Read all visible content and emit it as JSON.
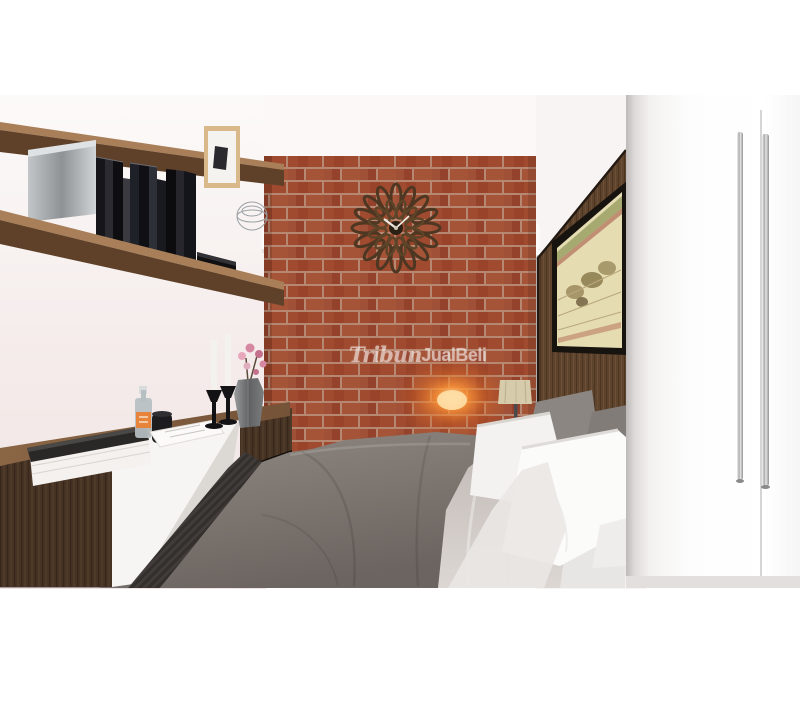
{
  "meta": {
    "type": "interior-3d-render",
    "description": "3D architectural render of a modern bedroom: central exposed red-brick accent wall with sunburst wall clock, flanked by recessed windows with white fluted column curtains, dark walnut floating shelves with books on the left above a floating media console with candlesticks and a vase of pink flowers, a double bed with gray duvet and white pillows in front of a dark wood headboard panel bearing a framed antique map, and a white two-door wardrobe with long steel handles in the right foreground."
  },
  "watermark": {
    "part1": "Tribun",
    "part2": "JualBeli",
    "color": "#ffffff"
  },
  "palette": {
    "wall_left": "#f2e9e8",
    "brick": "#a84f33",
    "mortar": "#c0927a",
    "wood_dark": "#463324",
    "wood_panel": "#5e432d",
    "wood_shelf": "#6b4a30",
    "duvet_gray": "#6e6762",
    "blanket_light": "#cfc8c4",
    "pillow_white": "#f3f2f0",
    "pillow_gray": "#8b8682",
    "floor_gray": "#8a8684",
    "wardrobe_white": "#fbfafa",
    "handle_steel": "#b9b9b9",
    "sconce_glow": "#ff8c28",
    "lamp_shade": "#d6cbaa",
    "flower_pink": "#d687a2",
    "map_paper": "#e6dcb2",
    "sky_view": "#e4eae9",
    "building_orange": "#de9a4c"
  },
  "scene": {
    "objects": [
      "brick accent wall",
      "sunburst wall clock",
      "recessed window left",
      "recessed window right",
      "fluted column curtains",
      "wood slat vents",
      "wall sconce glow",
      "floating wall shelves",
      "book collection",
      "metal storage box",
      "framed artwork",
      "wire basket",
      "black media device",
      "floating media console",
      "stacked books",
      "glass bottle",
      "black mug",
      "serving tray",
      "black candlesticks with white candles",
      "hexagonal vase with pink flowers",
      "table lamp",
      "wood headboard panel",
      "framed antique map",
      "double bed with gray duvet",
      "light gray throw blanket",
      "white and gray pillows",
      "white wardrobe with steel handles"
    ]
  }
}
